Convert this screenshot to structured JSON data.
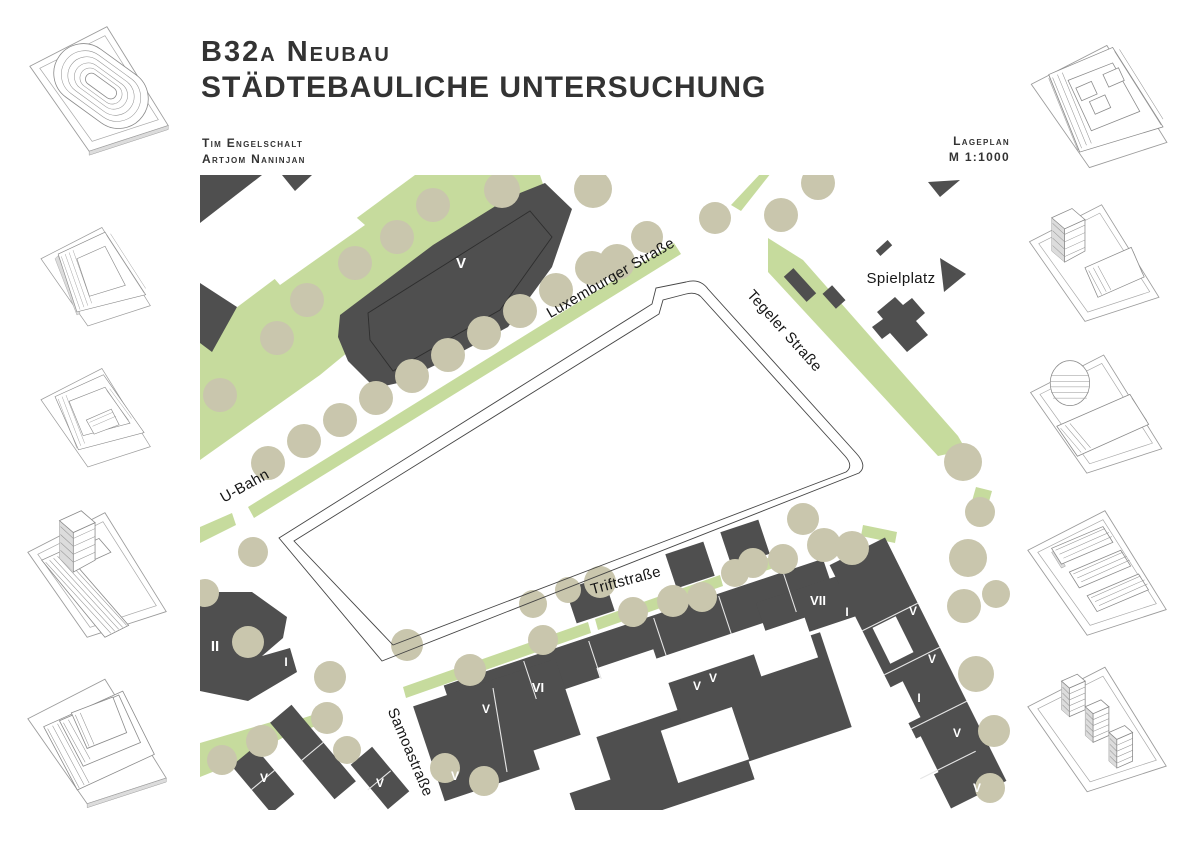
{
  "header": {
    "title_line1": "B32a Neubau",
    "title_line2": "Städtebauliche Untersuchung",
    "authors": [
      "Tim Engelschalt",
      "Artjom Naninjan"
    ],
    "plan_type": "Lageplan",
    "scale": "M 1:1000"
  },
  "map": {
    "colors": {
      "green": "#c6db9d",
      "tree": "#c9c6ad",
      "building": "#4f4f4f",
      "outline": "#454545",
      "street_text": "#161616",
      "numeral_text": "#ffffff"
    },
    "green_areas": [
      "0,160 120,70 215,0 340,0 345,15 120,200 0,285",
      "48,332 474,68 481,79 54,343",
      "0,352 32,338 36,350 0,368",
      "561,-2 571,-2 541,36 531,30",
      "568,63 603,85 758,261 766,275 738,281 568,97",
      "776,312 792,316 788,330 772,326",
      "203,512 388,447 391,458 206,523",
      "395,444 520,400 523,411 398,455",
      "528,396 583,378 586,389 531,407",
      "663,350 697,357 695,368 661,361",
      "0,568 78,545 96,556 30,590 0,602",
      "85,549 128,535 132,546 89,560"
    ],
    "green_gaps": [
      "45,70 125,15 165,50 80,110"
    ],
    "buildings": [
      "M140,140 L233,70 L310,22 L345,8 L372,34 L352,92 L308,152 L248,184 L198,208 L175,213 L148,186 L138,162 Z",
      "0,0 62,0 0,48",
      "82,0 112,0 95,16",
      "0,108 37,132 12,177 0,168",
      "728,7 760,5 740,22",
      "675.8,75.8 687.6,65 692.2,70.2 680.4,81",
      "740,83 766,99 744,117",
      "583.8,101.7 593.4,93.1 616.2,118.3 606.6,126.9",
      "622.5,118.9 632.1,110.3 645.5,125.1 635.9,133.7",
      "M677,137 L695,122 L703,130 L712,123 L725,138 L716,146 L728,160 L707,177 L690,158 L682,164 L672,152 L683,144 Z",
      "M0,417 L52,417 L87,442 L83,463 L62,481 L90,473 L97,497 L48,526 L0,516 Z",
      "31.6,590.9 54.6,571.7 94.4,619.1 71.4,638.3",
      "70.1,547.7 91.5,529.7 155.9,606.3 134.5,624.3",
      "150.7,589.8 172.1,571.8 209.3,616.2 187.9,634.2",
      "622.9,383.7 636.3,423.5 257.1,550.3 243.7,510.5",
      "355.3,483.8 387,578.6 244.8,626.2 213.1,531.4",
      "526,518.8 554.6,604.2 384,661.2 355.4,575.8",
      "620,457.2 651.7,552 500.1,602.8 468.4,508",
      "669.9,390.1 683.9,431.9 570.1,469.9 556.1,428.1",
      "629.6,390.1 685,362.5 806.4,605.9 751,633.5",
      "403.3,401.6 414.7,435.8 376.7,448.4 365.3,414.2",
      "503.3,366.6 514.7,400.8 476.7,413.4 465.3,379.2",
      "558.3,344.6 569.7,378.8 531.7,391.4 520.3,357.2"
    ],
    "courtyards": [
      "394.1,555.3 410.5,604.5 349.9,624.7 333.5,575.5",
      "531.8,532 549.2,584.2 478.2,608 460.8,555.8",
      "453.3,474.2 467.5,516.8 410.7,535.8 396.5,493.2",
      "604.7,442.6 618.1,482.4 561.3,501.4 547.9,461.6",
      "672.5,452.9 695.7,441.3 713.5,477.1 690.3,488.7",
      "679.5,517.9 702.7,506.3 720.5,542.1 697.3,553.7",
      "697.5,572.9 720.7,561.3 738.5,597.1 715.3,608.7"
    ],
    "dark_outlines": [
      "M168,138 L330,36 L352,62 L300,135 L193,196 L170,165 Z"
    ],
    "hairlines": [
      "323.7,486,336.3,524",
      "388.7,466,401.3,504",
      "453.7,443,466.3,481",
      "518.7,421,531.3,459",
      "583.7,399,596.3,437",
      "293,513,307,597",
      "717.7,428.2,662.3,455.8",
      "739.7,472.2,684.3,499.8",
      "766.7,526.2,711.3,553.8",
      "775.7,576.2,720.3,603.8",
      "74.5,595.4,51.5,614.6",
      "123.7,567,100.7,586.2",
      "190.7,595.8,167.7,615"
    ],
    "site_outline": {
      "outer": "M79,363 L452,129 L456,113 L486,107 Q500,103 508,114 L656,278 Q668,291 659,298 L182,486 Z",
      "inner": "M94,366 L459,139 L463,125 L486,119 Q497,116 503,124 L645,281 Q654,291 646,297 L193,470 Z"
    },
    "trees": [
      [
        20,
        220,
        17
      ],
      [
        77,
        163,
        17
      ],
      [
        107,
        125,
        17
      ],
      [
        155,
        88,
        17
      ],
      [
        197,
        62,
        17
      ],
      [
        233,
        30,
        17
      ],
      [
        302,
        15,
        18
      ],
      [
        393,
        14,
        19
      ],
      [
        447,
        62,
        16
      ],
      [
        417,
        87,
        18
      ],
      [
        515,
        43,
        16
      ],
      [
        581,
        40,
        17
      ],
      [
        618,
        8,
        17
      ],
      [
        68,
        288,
        17
      ],
      [
        104,
        266,
        17
      ],
      [
        140,
        245,
        17
      ],
      [
        176,
        223,
        17
      ],
      [
        212,
        201,
        17
      ],
      [
        248,
        180,
        17
      ],
      [
        284,
        158,
        17
      ],
      [
        320,
        136,
        17
      ],
      [
        356,
        115,
        17
      ],
      [
        392,
        93,
        17
      ],
      [
        53,
        377,
        15
      ],
      [
        5,
        418,
        14
      ],
      [
        48,
        467,
        16
      ],
      [
        130,
        502,
        16
      ],
      [
        127,
        543,
        16
      ],
      [
        62,
        566,
        16
      ],
      [
        22,
        585,
        15
      ],
      [
        147,
        575,
        14
      ],
      [
        245,
        593,
        15
      ],
      [
        284,
        606,
        15
      ],
      [
        207,
        470,
        16
      ],
      [
        270,
        495,
        16
      ],
      [
        333,
        429,
        14
      ],
      [
        343,
        465,
        15
      ],
      [
        368,
        415,
        13
      ],
      [
        400,
        407,
        16
      ],
      [
        433,
        437,
        15
      ],
      [
        473,
        426,
        16
      ],
      [
        502,
        422,
        15
      ],
      [
        535,
        398,
        14
      ],
      [
        553,
        388,
        15
      ],
      [
        583,
        384,
        15
      ],
      [
        603,
        344,
        16
      ],
      [
        624,
        370,
        17
      ],
      [
        652,
        373,
        17
      ],
      [
        763,
        287,
        19
      ],
      [
        780,
        337,
        15
      ],
      [
        768,
        383,
        19
      ],
      [
        764,
        431,
        17
      ],
      [
        796,
        419,
        14
      ],
      [
        776,
        499,
        18
      ],
      [
        794,
        556,
        16
      ],
      [
        790,
        613,
        15
      ]
    ],
    "street_labels": [
      {
        "text": "Luxemburger Straße",
        "x": 413,
        "y": 107,
        "rot": -30,
        "size": 15
      },
      {
        "text": "Tegeler Straße",
        "x": 581,
        "y": 159,
        "rot": 48,
        "size": 15
      },
      {
        "text": "Triftstraße",
        "x": 427,
        "y": 410,
        "rot": -15,
        "size": 15
      },
      {
        "text": "Samoastraße",
        "x": 206,
        "y": 579,
        "rot": 67,
        "size": 15
      },
      {
        "text": "U-Bahn",
        "x": 47,
        "y": 315,
        "rot": -29,
        "size": 14
      },
      {
        "text": "Spielplatz",
        "x": 701,
        "y": 108,
        "rot": 0,
        "size": 15
      }
    ],
    "building_labels": [
      {
        "text": "V",
        "x": 261,
        "y": 93,
        "size": 15
      },
      {
        "text": "II",
        "x": 15,
        "y": 476,
        "size": 15
      },
      {
        "text": "I",
        "x": 86,
        "y": 491,
        "size": 12
      },
      {
        "text": "V",
        "x": 64,
        "y": 607,
        "size": 12
      },
      {
        "text": "V",
        "x": 110,
        "y": 611,
        "size": 12
      },
      {
        "text": "V",
        "x": 180,
        "y": 612,
        "size": 12
      },
      {
        "text": "VI",
        "x": 338,
        "y": 517,
        "size": 13
      },
      {
        "text": "V",
        "x": 286,
        "y": 538,
        "size": 12
      },
      {
        "text": "V",
        "x": 255,
        "y": 605,
        "size": 12
      },
      {
        "text": "V",
        "x": 358,
        "y": 598,
        "size": 12
      },
      {
        "text": "V",
        "x": 407,
        "y": 540,
        "size": 12
      },
      {
        "text": "V",
        "x": 424,
        "y": 536,
        "size": 12
      },
      {
        "text": "V",
        "x": 497,
        "y": 515,
        "size": 12
      },
      {
        "text": "V",
        "x": 513,
        "y": 507,
        "size": 12
      },
      {
        "text": "V",
        "x": 585,
        "y": 492,
        "size": 12
      },
      {
        "text": "VII",
        "x": 618,
        "y": 430,
        "size": 13
      },
      {
        "text": "I",
        "x": 647,
        "y": 441,
        "size": 12
      },
      {
        "text": "V",
        "x": 713,
        "y": 440,
        "size": 12
      },
      {
        "text": "V",
        "x": 732,
        "y": 488,
        "size": 12
      },
      {
        "text": "I",
        "x": 719,
        "y": 527,
        "size": 12
      },
      {
        "text": "V",
        "x": 757,
        "y": 562,
        "size": 12
      },
      {
        "text": "V",
        "x": 777,
        "y": 617,
        "size": 12
      }
    ]
  },
  "sketches": {
    "left": [
      "stadium-ring-block",
      "perimeter-triangle-a",
      "perimeter-triangle-b",
      "slab-with-tower",
      "terraced-block"
    ],
    "right": [
      "courtyard-comb-block",
      "wedge-with-corner-tower",
      "round-tower-with-slab",
      "three-parallel-slabs",
      "three-point-towers"
    ]
  }
}
